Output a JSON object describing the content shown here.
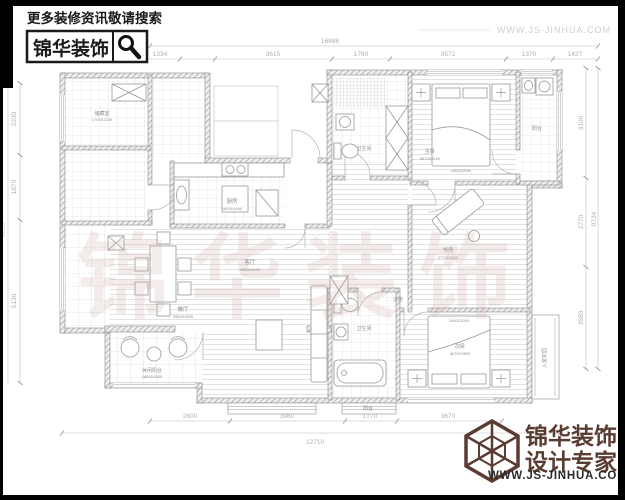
{
  "branding": {
    "top_left_hint": "更多装修资讯敬请搜索",
    "top_left_brand": "锦华装饰",
    "top_right_url": "WWW.JS-JINHUA.COM",
    "bottom_brand_line1": "锦华装饰",
    "bottom_brand_line2": "设计专家",
    "bottom_url": "WWW.JS-JINHUA.COM"
  },
  "watermark": "锦华装饰",
  "dimensions": {
    "top_total": "16888",
    "top_segments": [
      "3810",
      "1334",
      "3615",
      "1760",
      "3572",
      "1370",
      "1427"
    ],
    "left_segments": [
      "2230",
      "1870",
      "5130"
    ],
    "left_total": "9230",
    "right_segments": [
      "3100",
      "2770",
      "3580"
    ],
    "right_total": "9734",
    "bottom_segments": [
      "2800",
      "3980",
      "1770",
      "3670"
    ],
    "bottom_total": "12710"
  },
  "rooms": [
    {
      "name": "厨房",
      "sub": "2800X1650"
    },
    {
      "name": "餐厅",
      "sub": "3980X3400"
    },
    {
      "name": "客厅",
      "sub": "4500X6000"
    },
    {
      "name": "主卧",
      "sub": "3572X3100"
    },
    {
      "name": "书房",
      "sub": "2770X3300"
    },
    {
      "name": "次卧",
      "sub": "3670X2800"
    },
    {
      "name": "卫生间",
      "sub": ""
    },
    {
      "name": "卫生间",
      "sub": ""
    },
    {
      "name": "休闲阳台",
      "sub": "2800X1500"
    },
    {
      "name": "过道",
      "sub": ""
    },
    {
      "name": "入室花园",
      "sub": ""
    },
    {
      "name": "阳台",
      "sub": ""
    },
    {
      "name": "储藏室",
      "sub": "1700X2230"
    },
    {
      "name": "阳台",
      "sub": ""
    }
  ],
  "furniture": {
    "master_bed_size": "1800X2000",
    "second_bed_size": "1500X2000"
  },
  "colors": {
    "brand_black": "#111111",
    "brand_maroon": "#5a3c32",
    "plan_line": "#9a9a9a",
    "dim_text": "#b0b0b0"
  }
}
